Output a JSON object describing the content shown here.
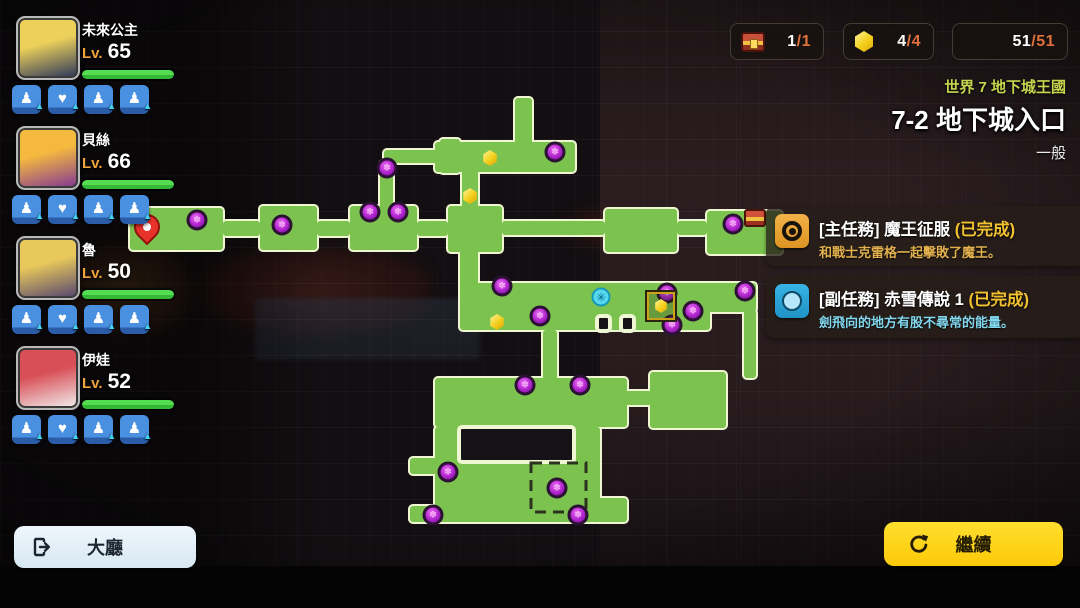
{
  "party": {
    "members": [
      {
        "name": "未來公主",
        "level_label": "Lv.",
        "level": "65",
        "hp_percent": 100,
        "buffs": [
          "♟",
          "♥",
          "♟",
          "♟"
        ],
        "portrait_colors": [
          "#ecd05a",
          "#37405a"
        ]
      },
      {
        "name": "貝絲",
        "level_label": "Lv.",
        "level": "66",
        "hp_percent": 100,
        "buffs": [
          "♟",
          "♥",
          "♟",
          "♟"
        ],
        "portrait_colors": [
          "#f5b93e",
          "#8a3f8f"
        ]
      },
      {
        "name": "魯",
        "level_label": "Lv.",
        "level": "50",
        "hp_percent": 100,
        "buffs": [
          "♟",
          "♥",
          "♟",
          "♟"
        ],
        "portrait_colors": [
          "#e8c85a",
          "#5f4e6e"
        ]
      },
      {
        "name": "伊娃",
        "level_label": "Lv.",
        "level": "52",
        "hp_percent": 100,
        "buffs": [
          "♟",
          "♥",
          "♟",
          "♟"
        ],
        "portrait_colors": [
          "#d94f57",
          "#efe3e3"
        ]
      }
    ],
    "buff_arrow_glyph": "▲"
  },
  "counters": [
    {
      "icon": "treasure-chest-icon",
      "current": "1",
      "total": "/1"
    },
    {
      "icon": "gem-icon",
      "current": "4",
      "total": "/4"
    },
    {
      "icon": "demon-icon",
      "current": "51",
      "total": "/51"
    }
  ],
  "stage": {
    "world_label": "世界 7 地下城王國",
    "stage_title": "7-2 地下城入口",
    "difficulty": "一般"
  },
  "quests": [
    {
      "type_label": "[主任務]",
      "name": "魔王征服",
      "status": "(已完成)",
      "description": "和戰士克雷格一起擊敗了魔王。",
      "icon": "main-quest-icon",
      "accent": "#E8A02E"
    },
    {
      "type_label": "[副任務]",
      "name": "赤雪傳說 1",
      "status": "(已完成)",
      "description": "劍飛向的地方有股不尋常的能量。",
      "icon": "sub-quest-icon",
      "accent": "#2FA8DC"
    }
  ],
  "buttons": {
    "lobby_label": "大廳",
    "continue_label": "繼續"
  },
  "map": {
    "colors": {
      "room_fill": "#7cc24e",
      "room_edge": "#eef6d2",
      "cut_fill": "#171218",
      "boss_dash": "#2b331e"
    },
    "rooms": [
      [
        130,
        208,
        93,
        42
      ],
      [
        223,
        221,
        37,
        15
      ],
      [
        260,
        206,
        57,
        44
      ],
      [
        317,
        221,
        33,
        15
      ],
      [
        350,
        206,
        67,
        44
      ],
      [
        417,
        221,
        31,
        15
      ],
      [
        448,
        206,
        54,
        46
      ],
      [
        502,
        221,
        103,
        14
      ],
      [
        605,
        209,
        72,
        43
      ],
      [
        677,
        221,
        30,
        14
      ],
      [
        707,
        211,
        75,
        43
      ],
      [
        515,
        98,
        17,
        50
      ],
      [
        435,
        142,
        140,
        30
      ],
      [
        462,
        170,
        16,
        42
      ],
      [
        384,
        150,
        56,
        13
      ],
      [
        440,
        139,
        20,
        34
      ],
      [
        380,
        161,
        13,
        50
      ],
      [
        460,
        246,
        18,
        42
      ],
      [
        460,
        283,
        250,
        47
      ],
      [
        700,
        283,
        56,
        29
      ],
      [
        744,
        310,
        12,
        68
      ],
      [
        543,
        330,
        14,
        50
      ],
      [
        435,
        378,
        192,
        49
      ],
      [
        625,
        391,
        27,
        14
      ],
      [
        650,
        372,
        76,
        56
      ],
      [
        435,
        427,
        165,
        95
      ],
      [
        435,
        498,
        192,
        24
      ],
      [
        410,
        458,
        27,
        16
      ],
      [
        410,
        506,
        27,
        16
      ]
    ],
    "cuts": [
      [
        459,
        427,
        115,
        35
      ],
      [
        597,
        316,
        13,
        15
      ],
      [
        621,
        316,
        13,
        15
      ]
    ],
    "boss_frame": [
      531,
      463,
      55,
      49
    ],
    "markers": {
      "enemies": [
        [
          197,
          220
        ],
        [
          282,
          225
        ],
        [
          370,
          212
        ],
        [
          398,
          212
        ],
        [
          555,
          152
        ],
        [
          387,
          168
        ],
        [
          733,
          224
        ],
        [
          502,
          286
        ],
        [
          540,
          316
        ],
        [
          667,
          293
        ],
        [
          693,
          311
        ],
        [
          672,
          325
        ],
        [
          745,
          291
        ],
        [
          525,
          385
        ],
        [
          580,
          385
        ],
        [
          448,
          472
        ],
        [
          433,
          515
        ],
        [
          578,
          515
        ],
        [
          557,
          488
        ]
      ],
      "gems": [
        [
          490,
          158
        ],
        [
          470,
          196
        ],
        [
          497,
          322
        ]
      ],
      "gem_square": [
        [
          661,
          306
        ]
      ],
      "snowflake": [
        [
          601,
          297
        ]
      ],
      "snowflake_glyph": "✳",
      "chest": [
        [
          755,
          218
        ]
      ],
      "pin": [
        [
          147,
          240
        ]
      ]
    }
  }
}
